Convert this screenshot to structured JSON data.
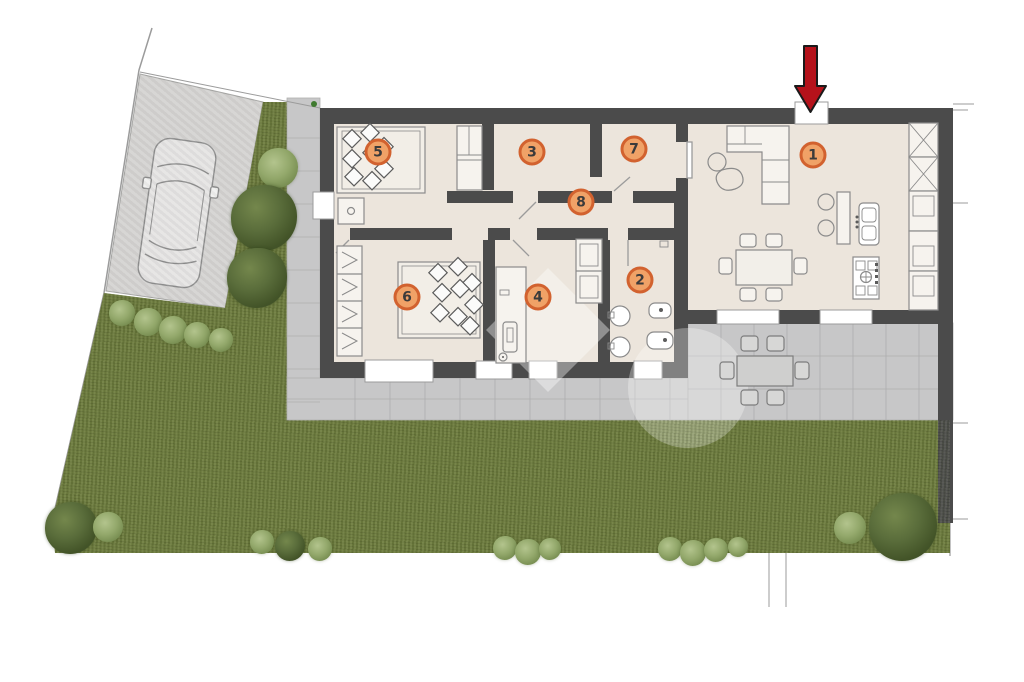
{
  "plan": {
    "type": "residential-floor-plan",
    "rooms": [
      {
        "label": "1",
        "x": 813,
        "y": 155
      },
      {
        "label": "2",
        "x": 640,
        "y": 280
      },
      {
        "label": "3",
        "x": 532,
        "y": 152
      },
      {
        "label": "4",
        "x": 538,
        "y": 297
      },
      {
        "label": "5",
        "x": 378,
        "y": 152
      },
      {
        "label": "6",
        "x": 407,
        "y": 297
      },
      {
        "label": "7",
        "x": 634,
        "y": 149
      },
      {
        "label": "8",
        "x": 581,
        "y": 202
      }
    ],
    "badge_style": {
      "fill": "#f0a267",
      "border": "#d2622f",
      "text_color": "#3b3b3b"
    },
    "entrance": {
      "marker": "red-arrow",
      "direction": "down"
    },
    "palette": {
      "wall": "#4b4b4b",
      "floor": "#ece5dc",
      "grass": "#6c7a3d",
      "paving": "#c7c7c8",
      "driveway": "#d4d3d1",
      "arrow_red": "#b5121b",
      "tree_dark": "#435428",
      "tree_light": "#8aa162"
    },
    "icons": [
      "car-icon",
      "tree-icon",
      "bush-icon",
      "entrance-arrow-icon",
      "watermark-logo"
    ]
  }
}
